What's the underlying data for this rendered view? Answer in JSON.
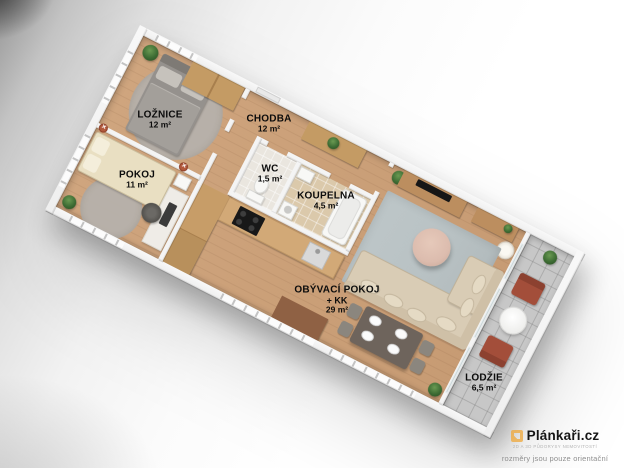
{
  "rooms": [
    {
      "id": "loznice",
      "name": "LOŽNICE",
      "area": "12 m²"
    },
    {
      "id": "pokoj",
      "name": "POKOJ",
      "area": "11 m²"
    },
    {
      "id": "chodba",
      "name": "CHODBA",
      "area": "12 m²"
    },
    {
      "id": "wc",
      "name": "WC",
      "area": "1,5 m²"
    },
    {
      "id": "koupelna",
      "name": "KOUPELNA",
      "area": "4,5 m²"
    },
    {
      "id": "obyvaci-pokoj",
      "name": "OBÝVACÍ POKOJ",
      "suffix": "+ KK",
      "area": "29 m²"
    },
    {
      "id": "lodzie",
      "name": "LODŽIE",
      "area": "6,5 m²"
    }
  ],
  "watermark": {
    "brand": "Plánkaři.cz",
    "tagline": "2D A 3D PŮDORYSY NEMOVITOSTÍ",
    "disclaimer": "rozměry jsou pouze orientační"
  },
  "wall_light_symbol": "✕",
  "colors": {
    "floor-wood": "#cfa57e",
    "wall": "#f4f4f4",
    "tile-bath": "#dbc9ab",
    "tile-loggia": "#c7c7c7",
    "rug-gray": "#b6b2ad",
    "rug-living": "#b9c2c4",
    "sofa": "#d9ccb5",
    "bed-master": "#95918d",
    "bed-single": "#e9dfc2",
    "wood-furniture": "#c49b64",
    "wood-console": "#bc8e5f",
    "chair-loggia": "#a34e3a",
    "table-dining": "#6e645c",
    "coffee-table": "#dcbcae",
    "plant": "#3c6b33",
    "accent-logo": "#f0a839"
  }
}
